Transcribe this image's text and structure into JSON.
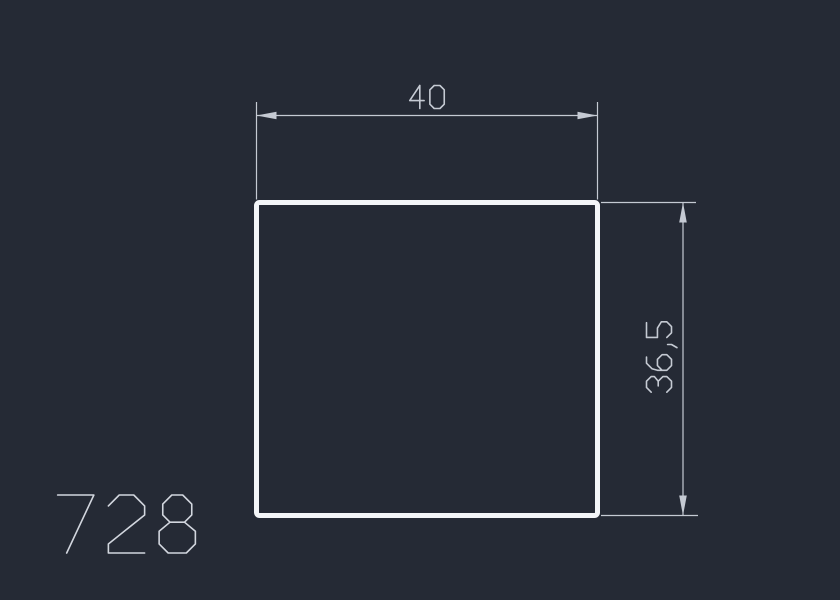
{
  "drawing": {
    "part_number": "728",
    "background_color": "#252a35",
    "profile": {
      "shape": "square",
      "outline_color": "#f3f5f8"
    },
    "dimensions": {
      "line_color": "#c5cad3",
      "width": {
        "label": "40",
        "orientation": "horizontal"
      },
      "height": {
        "label": "36,5",
        "orientation": "vertical"
      }
    },
    "part_number_color": "#d2d6de"
  }
}
